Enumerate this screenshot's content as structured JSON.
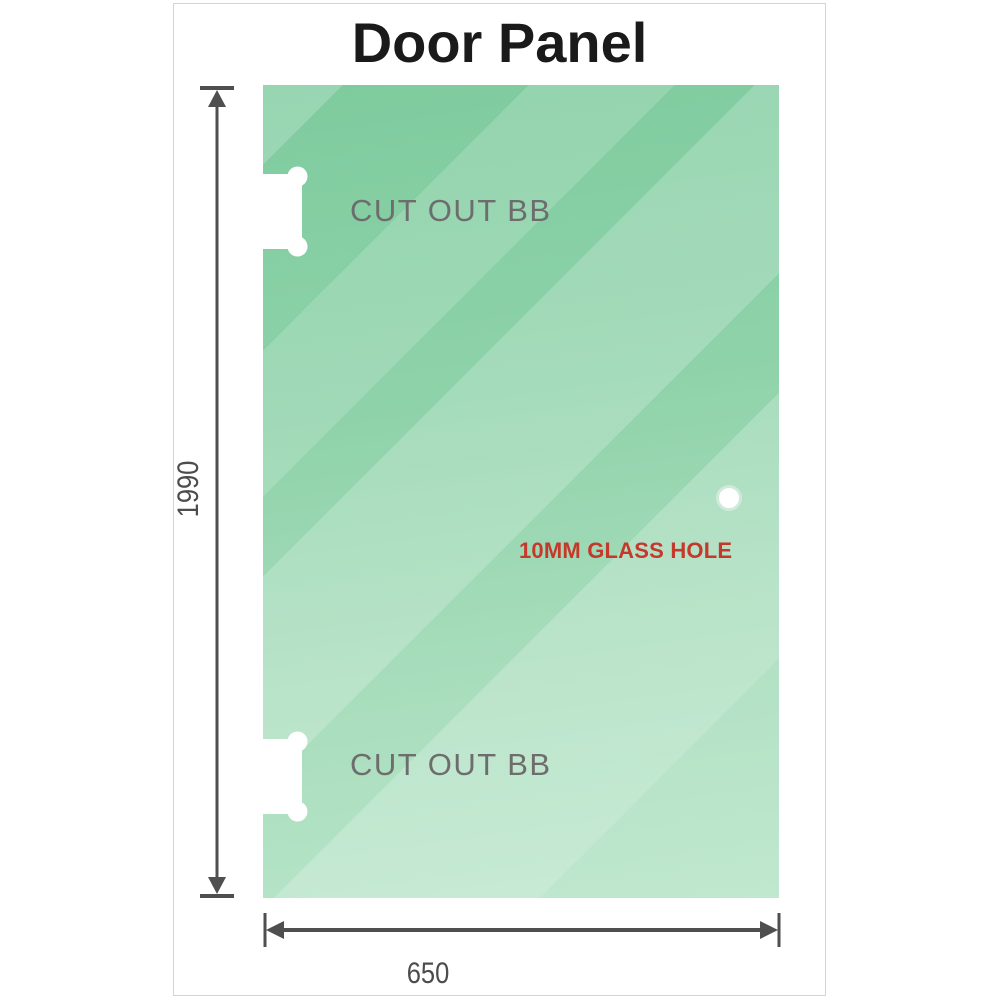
{
  "title": "Door Panel",
  "panel": {
    "cutouts": [
      {
        "label": "CUT OUT BB",
        "position": "top-left"
      },
      {
        "label": "CUT OUT BB",
        "position": "bottom-left"
      }
    ],
    "hole": {
      "label": "10MM GLASS HOLE"
    }
  },
  "dimensions": {
    "height": "1990",
    "width": "650"
  },
  "colors": {
    "glass_top": "#7ecb9e",
    "glass_bottom": "#b9e5ca",
    "dimension_line": "#4f4f4f",
    "cutout_label": "#6d6d6d",
    "hole_label": "#c4392c",
    "title": "#1a1a1a",
    "card_border": "#d4d4d4",
    "cutout_fill": "#ffffff"
  }
}
